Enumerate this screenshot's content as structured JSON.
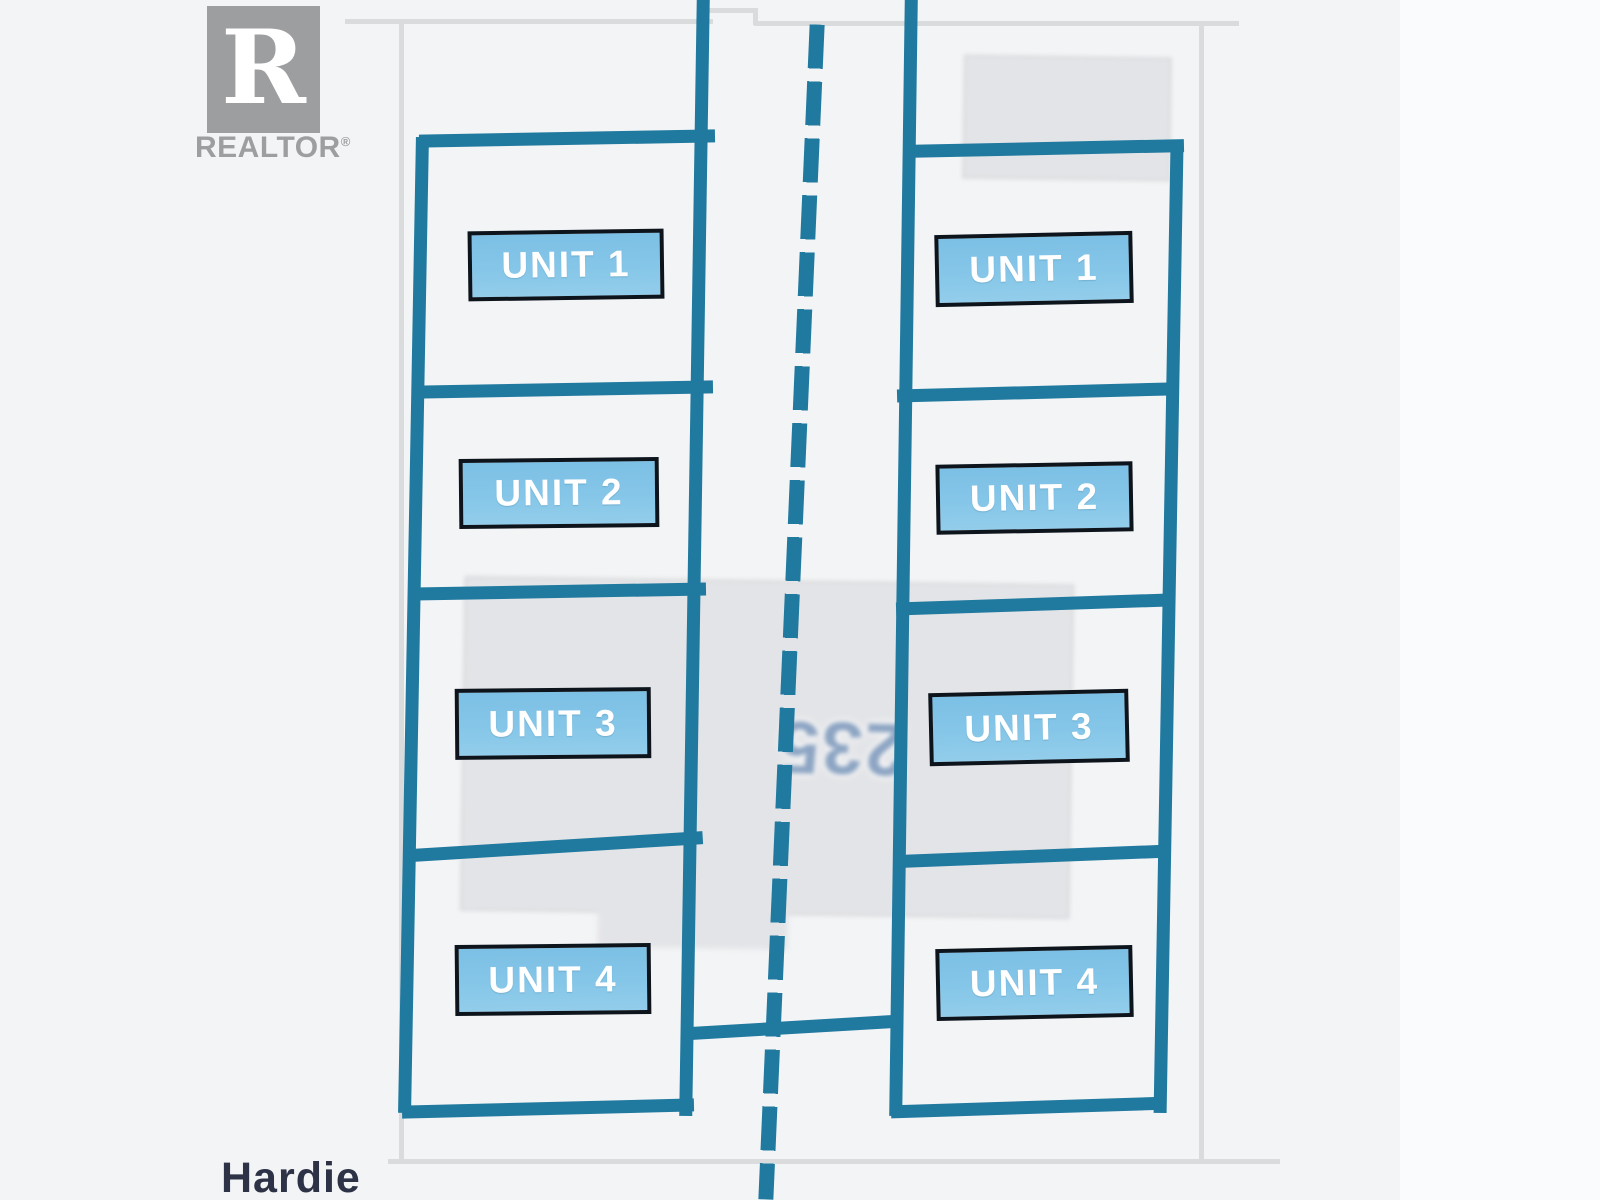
{
  "branding": {
    "logo_letter": "R",
    "logo_name": "REALTOR",
    "registered_mark": "®"
  },
  "street": {
    "name": "Hardie"
  },
  "ghost_text": {
    "value": "235",
    "note_orientation": "rotated-180-degrees"
  },
  "buildings": {
    "left": {
      "units": [
        "UNIT 1",
        "UNIT 2",
        "UNIT 3",
        "UNIT 4"
      ]
    },
    "right": {
      "units": [
        "UNIT 1",
        "UNIT 2",
        "UNIT 3",
        "UNIT 4"
      ]
    }
  },
  "colors": {
    "survey_teal": "#20799f",
    "unit_label_fill": "#7ec2e6",
    "unit_label_border": "#0d141c",
    "unit_label_text": "#ffffff",
    "ghost_number_blue": "#8da5c3",
    "footprint_gray": "#e3e4e7",
    "boundary_gray": "#d9dbdd",
    "street_text": "#2d3246",
    "realtor_gray": "#9d9ea0",
    "background": "#f3f4f6"
  }
}
